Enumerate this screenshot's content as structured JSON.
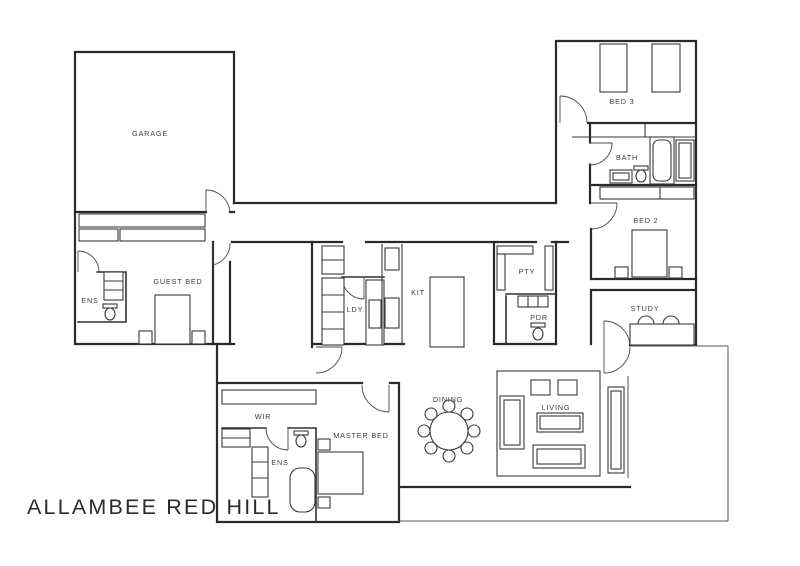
{
  "title": "ALLAMBEE RED HILL",
  "palette": {
    "ink": "#2a2a2a",
    "paper": "#ffffff"
  },
  "plan": {
    "rooms": [
      {
        "id": "garage",
        "label": "GARAGE"
      },
      {
        "id": "guest-bed",
        "label": "GUEST BED"
      },
      {
        "id": "guest-ens",
        "label": "ENS"
      },
      {
        "id": "laundry",
        "label": "LDY"
      },
      {
        "id": "kitchen",
        "label": "KIT"
      },
      {
        "id": "pantry",
        "label": "PTY"
      },
      {
        "id": "powder",
        "label": "PDR"
      },
      {
        "id": "bed3",
        "label": "BED 3"
      },
      {
        "id": "bath",
        "label": "BATH"
      },
      {
        "id": "bed2",
        "label": "BED 2"
      },
      {
        "id": "study",
        "label": "STUDY"
      },
      {
        "id": "wir",
        "label": "WIR"
      },
      {
        "id": "master-bed",
        "label": "MASTER BED"
      },
      {
        "id": "master-ens",
        "label": "ENS"
      },
      {
        "id": "dining",
        "label": "DINING"
      },
      {
        "id": "living",
        "label": "LIVING"
      }
    ]
  }
}
